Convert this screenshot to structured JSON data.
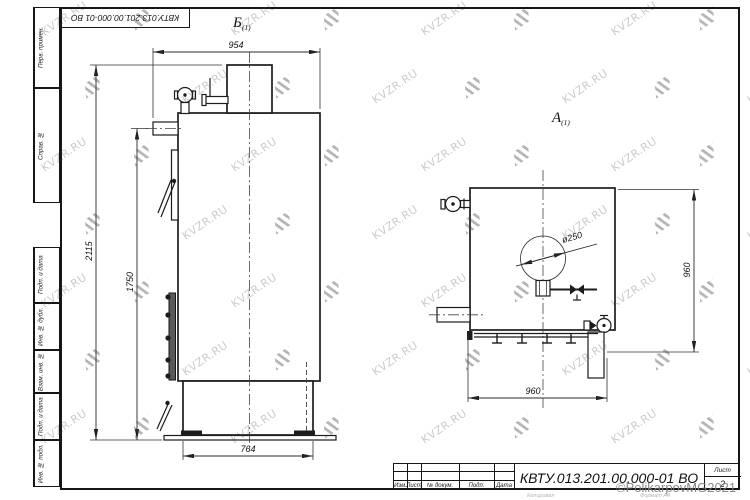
{
  "watermark": {
    "text": "KVZR.RU"
  },
  "copyright": "©PolikarpovMG2021",
  "copy_note": "Копировал",
  "format_note": "Формат А4",
  "corner_designation": "КВТУ.013.201.00.000-01 ВО",
  "margin_fields": {
    "f1": "Перв. примен.",
    "f2": "Справ. №",
    "f3": "Подп. и дата",
    "f4": "Инв. № дубл.",
    "f5": "Взам. инв. №",
    "f6": "Подп. и дата",
    "f7": "Инв. № подл."
  },
  "title_block": {
    "col_izm": "Изм.",
    "col_list": "Лист",
    "col_doc": "№ докум.",
    "col_sign": "Подп.",
    "col_date": "Дата",
    "designation": "КВТУ.013.201.00.000-01 ВО",
    "sheet_label": "Лист",
    "sheet_number": "2"
  },
  "views": {
    "side": {
      "label": "Б",
      "label_sub": "(1)",
      "dim_width": "954",
      "dim_height_total": "2115",
      "dim_height_pipe": "1750",
      "dim_base": "764"
    },
    "front": {
      "label": "А",
      "label_sub": "(1)",
      "dim_diameter": "ø250",
      "dim_height": "960",
      "dim_width": "960"
    }
  }
}
